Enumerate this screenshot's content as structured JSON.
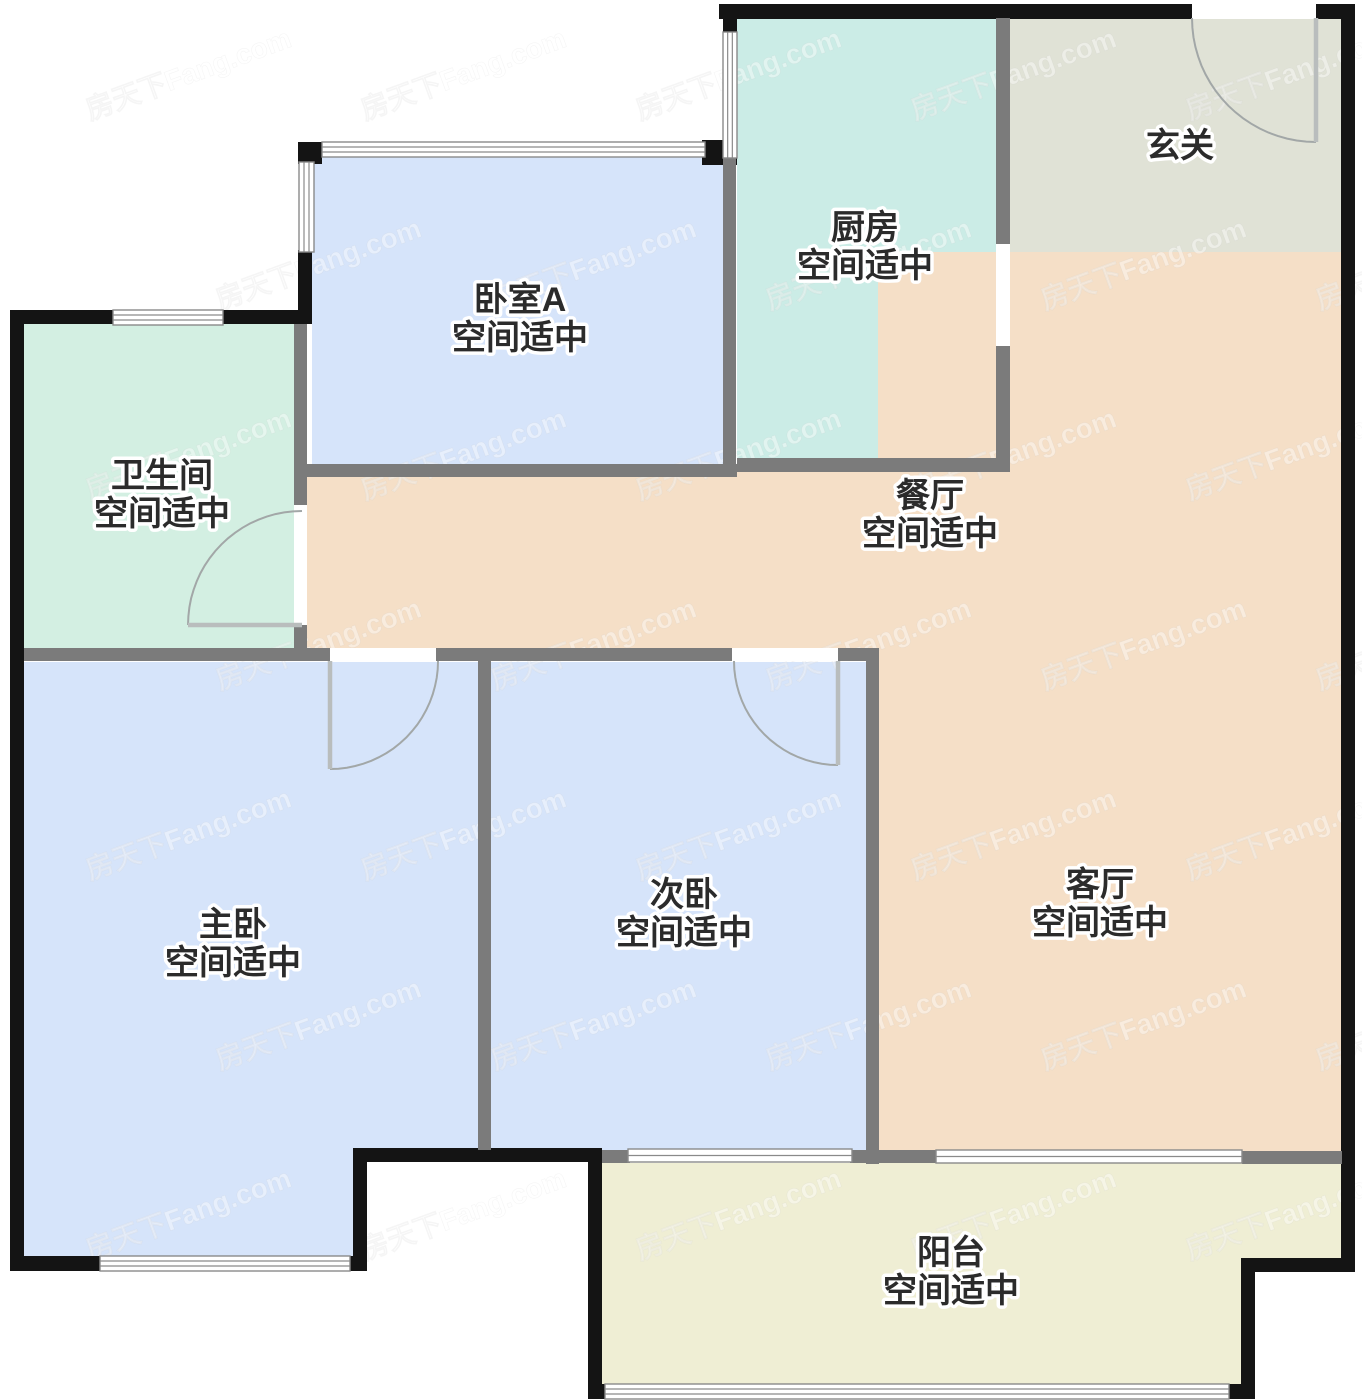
{
  "canvas": {
    "width": 1362,
    "height": 1400,
    "background": "#ffffff"
  },
  "watermark": {
    "text": "房天下Fang.com",
    "color": "#ffffff",
    "opacity": 0.42,
    "font_size": 28,
    "rotation": -20,
    "rows": 7,
    "cols": 5
  },
  "palette": {
    "bedroom_fill": "#d6e4fa",
    "kitchen_fill": "#cbece6",
    "bathroom_fill": "#d3efe2",
    "foyer_fill": "#e0e2d6",
    "hall_fill": "#f5dfc7",
    "balcony_fill": "#efeed4",
    "exterior_wall": "#141414",
    "interior_wall": "#7b7b7b",
    "window_stroke": "#8a8a8a",
    "door_line": "#a2a7a7",
    "label_color": "#2b2b2b"
  },
  "rooms": [
    {
      "id": "foyer",
      "label": "玄关",
      "sublabel": "",
      "fill": "#e0e2d6",
      "rects": [
        [
          1010,
          18,
          331,
          234
        ]
      ],
      "label_pos": [
        1180,
        148
      ]
    },
    {
      "id": "kitchen",
      "label": "厨房",
      "sublabel": "空间适中",
      "fill": "#cbece6",
      "rects": [
        [
          737,
          18,
          259,
          442
        ]
      ],
      "label_pos": [
        865,
        230
      ]
    },
    {
      "id": "bedroomA",
      "label": "卧室A",
      "sublabel": "空间适中",
      "fill": "#d6e4fa",
      "rects": [
        [
          312,
          156,
          411,
          308
        ]
      ],
      "label_pos": [
        520,
        302
      ]
    },
    {
      "id": "bathroom",
      "label": "卫生间",
      "sublabel": "空间适中",
      "fill": "#d3efe2",
      "rects": [
        [
          24,
          324,
          270,
          324
        ]
      ],
      "label_pos": [
        162,
        478
      ]
    },
    {
      "id": "dining",
      "label": "餐厅",
      "sublabel": "空间适中",
      "fill": "#f5dfc7",
      "rects": [
        [
          307,
          464,
          703,
          190
        ]
      ],
      "label_pos": [
        930,
        498
      ]
    },
    {
      "id": "living",
      "label": "客厅",
      "sublabel": "空间适中",
      "fill": "#f5dfc7",
      "rects": [
        [
          878,
          252,
          463,
          899
        ]
      ],
      "label_pos": [
        1100,
        887
      ]
    },
    {
      "id": "master",
      "label": "主卧",
      "sublabel": "空间适中",
      "fill": "#d6e4fa",
      "rects": [
        [
          24,
          662,
          454,
          486
        ],
        [
          24,
          662,
          336,
          594
        ]
      ],
      "label_pos": [
        233,
        927
      ]
    },
    {
      "id": "second",
      "label": "次卧",
      "sublabel": "空间适中",
      "fill": "#d6e4fa",
      "rects": [
        [
          491,
          662,
          375,
          488
        ]
      ],
      "label_pos": [
        684,
        897
      ]
    },
    {
      "id": "balcony",
      "label": "阳台",
      "sublabel": "空间适中",
      "fill": "#efeed4",
      "polygon": [
        [
          602,
          1163
        ],
        [
          1341,
          1163
        ],
        [
          1341,
          1258
        ],
        [
          1255,
          1258
        ],
        [
          1255,
          1384
        ],
        [
          602,
          1384
        ]
      ],
      "label_pos": [
        951,
        1255
      ]
    }
  ],
  "walls": {
    "exterior": {
      "color": "#141414",
      "rects": [
        [
          719,
          4,
          473,
          15
        ],
        [
          1316,
          4,
          25,
          15
        ],
        [
          1341,
          4,
          14,
          1268
        ],
        [
          1241,
          1258,
          114,
          14
        ],
        [
          1241,
          1258,
          14,
          141
        ],
        [
          1227,
          1384,
          28,
          15
        ],
        [
          588,
          1384,
          17,
          15
        ],
        [
          588,
          1148,
          14,
          251
        ],
        [
          353,
          1148,
          249,
          14
        ],
        [
          353,
          1148,
          14,
          122
        ],
        [
          348,
          1256,
          19,
          15
        ],
        [
          10,
          1256,
          90,
          15
        ],
        [
          10,
          310,
          14,
          961
        ],
        [
          10,
          310,
          105,
          14
        ],
        [
          223,
          310,
          89,
          14
        ],
        [
          298,
          250,
          14,
          62
        ],
        [
          298,
          142,
          24,
          22
        ],
        [
          702,
          140,
          35,
          25
        ],
        [
          723,
          4,
          14,
          30
        ]
      ]
    },
    "interior": {
      "color": "#7b7b7b",
      "rects": [
        [
          996,
          18,
          14,
          226
        ],
        [
          996,
          346,
          14,
          126
        ],
        [
          737,
          458,
          273,
          14
        ],
        [
          305,
          464,
          432,
          13
        ],
        [
          723,
          156,
          13,
          310
        ],
        [
          294,
          324,
          13,
          183
        ],
        [
          294,
          625,
          13,
          29
        ],
        [
          24,
          648,
          306,
          13
        ],
        [
          436,
          648,
          296,
          13
        ],
        [
          838,
          648,
          40,
          13
        ],
        [
          478,
          661,
          13,
          489
        ],
        [
          866,
          648,
          13,
          516
        ],
        [
          602,
          1150,
          28,
          13
        ],
        [
          850,
          1150,
          86,
          13
        ],
        [
          1242,
          1151,
          100,
          13
        ]
      ]
    }
  },
  "windows": {
    "fill": "#ffffff",
    "stroke": "#8a8a8a",
    "items": [
      {
        "name": "bedroomA-top-window",
        "rect": [
          322,
          142,
          383,
          15
        ],
        "dir": "h",
        "lines": 2
      },
      {
        "name": "bedroomA-left-window",
        "rect": [
          299,
          162,
          15,
          90
        ],
        "dir": "v",
        "lines": 2
      },
      {
        "name": "bathroom-top-window",
        "rect": [
          113,
          310,
          110,
          15
        ],
        "dir": "h",
        "lines": 2
      },
      {
        "name": "kitchen-left-window",
        "rect": [
          723,
          32,
          14,
          126
        ],
        "dir": "v",
        "lines": 2
      },
      {
        "name": "master-bottom-window",
        "rect": [
          100,
          1256,
          250,
          15
        ],
        "dir": "h",
        "lines": 2
      },
      {
        "name": "balcony-bottom-window",
        "rect": [
          605,
          1384,
          624,
          15
        ],
        "dir": "h",
        "lines": 2
      },
      {
        "name": "second-balcony-slider",
        "rect": [
          628,
          1149,
          224,
          13
        ],
        "dir": "h",
        "lines": 1
      },
      {
        "name": "living-balcony-slider",
        "rect": [
          936,
          1150,
          306,
          13
        ],
        "dir": "h",
        "lines": 1
      }
    ]
  },
  "doors": {
    "line_color": "#a2a7a7",
    "leaf_color": "#b9bdbd",
    "items": [
      {
        "name": "entry-door",
        "gap": [
          1192,
          4,
          124,
          15
        ],
        "leaf": [
          [
            1316,
            18
          ],
          [
            1316,
            142
          ]
        ],
        "arc": {
          "cx": 1316,
          "cy": 18,
          "r": 124,
          "a0": 90,
          "a1": 180
        }
      },
      {
        "name": "kitchen-doorway",
        "gap": [
          996,
          244,
          14,
          102
        ],
        "leaf": null,
        "arc": null
      },
      {
        "name": "bathroom-door",
        "gap": [
          294,
          505,
          13,
          120
        ],
        "leaf": [
          [
            302,
            625
          ],
          [
            188,
            625
          ]
        ],
        "arc": {
          "cx": 302,
          "cy": 625,
          "r": 114,
          "a0": 180,
          "a1": 270
        }
      },
      {
        "name": "master-bedroom-door",
        "gap": [
          330,
          648,
          106,
          13
        ],
        "leaf": [
          [
            330,
            661
          ],
          [
            330,
            769
          ]
        ],
        "arc": {
          "cx": 330,
          "cy": 661,
          "r": 108,
          "a0": 0,
          "a1": 90
        }
      },
      {
        "name": "second-bedroom-door",
        "gap": [
          732,
          648,
          106,
          13
        ],
        "leaf": [
          [
            838,
            661
          ],
          [
            838,
            765
          ]
        ],
        "arc": {
          "cx": 838,
          "cy": 661,
          "r": 104,
          "a0": 90,
          "a1": 180
        }
      }
    ]
  },
  "label_style": {
    "font_size": 34,
    "line_gap": 38
  }
}
